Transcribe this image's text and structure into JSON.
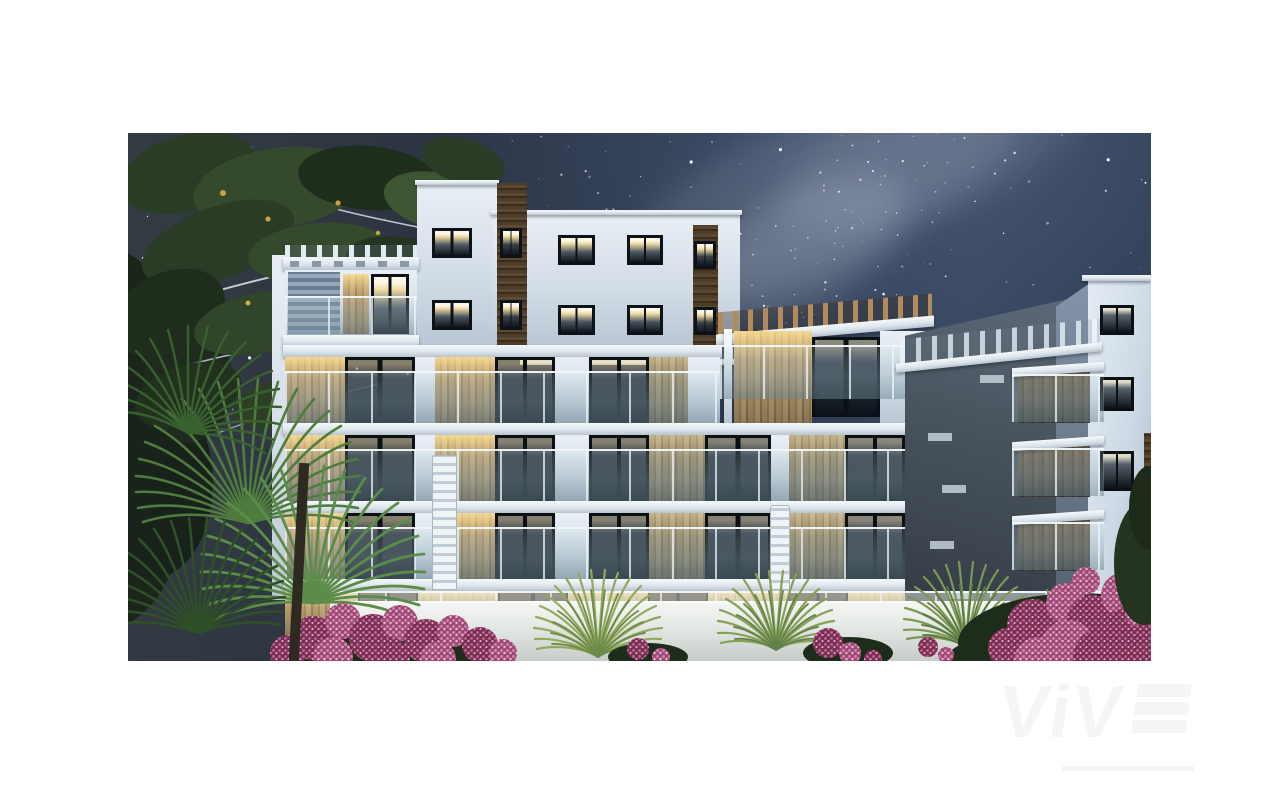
{
  "image": {
    "alt": "Night-time 3D architectural render of a modern white apartment complex with glass balconies, warm lit windows, wood and stone accents, palm trees and pink flowering shrubs in front of a white garden wall, under a starry sky with the Milky Way; large tree branches and palm fronds frame the left side",
    "time_of_day": "night",
    "subject": "new-build apartment residential complex"
  },
  "watermark": {
    "text": "ViV",
    "bars": 3,
    "tagline_present": true
  },
  "palette": {
    "sky": "#2b3850",
    "milky_way": "#dfe6f4",
    "facade_white": "#e9eff5",
    "facade_shadow": "#aabacb",
    "wood_accent": "#4e3d29",
    "stone_warm": "#b49a71",
    "window_light": "#f5dda0",
    "balcony_glass": "#9fb9c0",
    "foliage_dark": "#2b3c26",
    "palm_green": "#4f7c3e",
    "flower_pink": "#c06a9a",
    "flower_deep": "#7a2f52",
    "garden_wall": "#e9ece9",
    "watermark": "#f5f5f6"
  }
}
